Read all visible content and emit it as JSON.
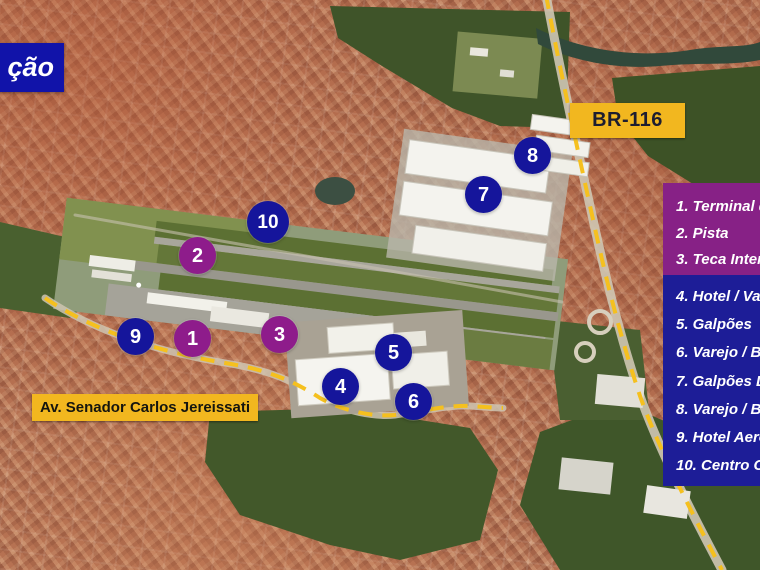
{
  "slide": {
    "title_fragment": "ção"
  },
  "map_labels": {
    "highway": "BR-116",
    "avenue": "Av. Senador Carlos Jereissati"
  },
  "legend": {
    "purple_items": [
      "1. Terminal d",
      "2. Pista",
      "3. Teca Inter"
    ],
    "blue_items": [
      "4. Hotel / Va",
      "5. Galpões",
      "6. Varejo / B",
      "7. Galpões Lo",
      "8. Varejo / B",
      "9. Hotel Aero",
      "10. Centro C"
    ]
  },
  "markers": [
    {
      "label": "1",
      "group": "purple"
    },
    {
      "label": "2",
      "group": "purple"
    },
    {
      "label": "3",
      "group": "purple"
    },
    {
      "label": "4",
      "group": "blue"
    },
    {
      "label": "5",
      "group": "blue"
    },
    {
      "label": "6",
      "group": "blue"
    },
    {
      "label": "7",
      "group": "blue"
    },
    {
      "label": "8",
      "group": "blue"
    },
    {
      "label": "9",
      "group": "blue"
    },
    {
      "label": "10",
      "group": "blue"
    }
  ],
  "colors": {
    "marker_purple": "#8e1c8b",
    "marker_blue": "#15159b",
    "legend_purple_bg": "#872186",
    "legend_blue_bg": "#1d1d97",
    "title_bg": "#1113a9",
    "yellow_label_bg": "#f2b71f",
    "dashed_route_yellow": "#f5c01e"
  }
}
